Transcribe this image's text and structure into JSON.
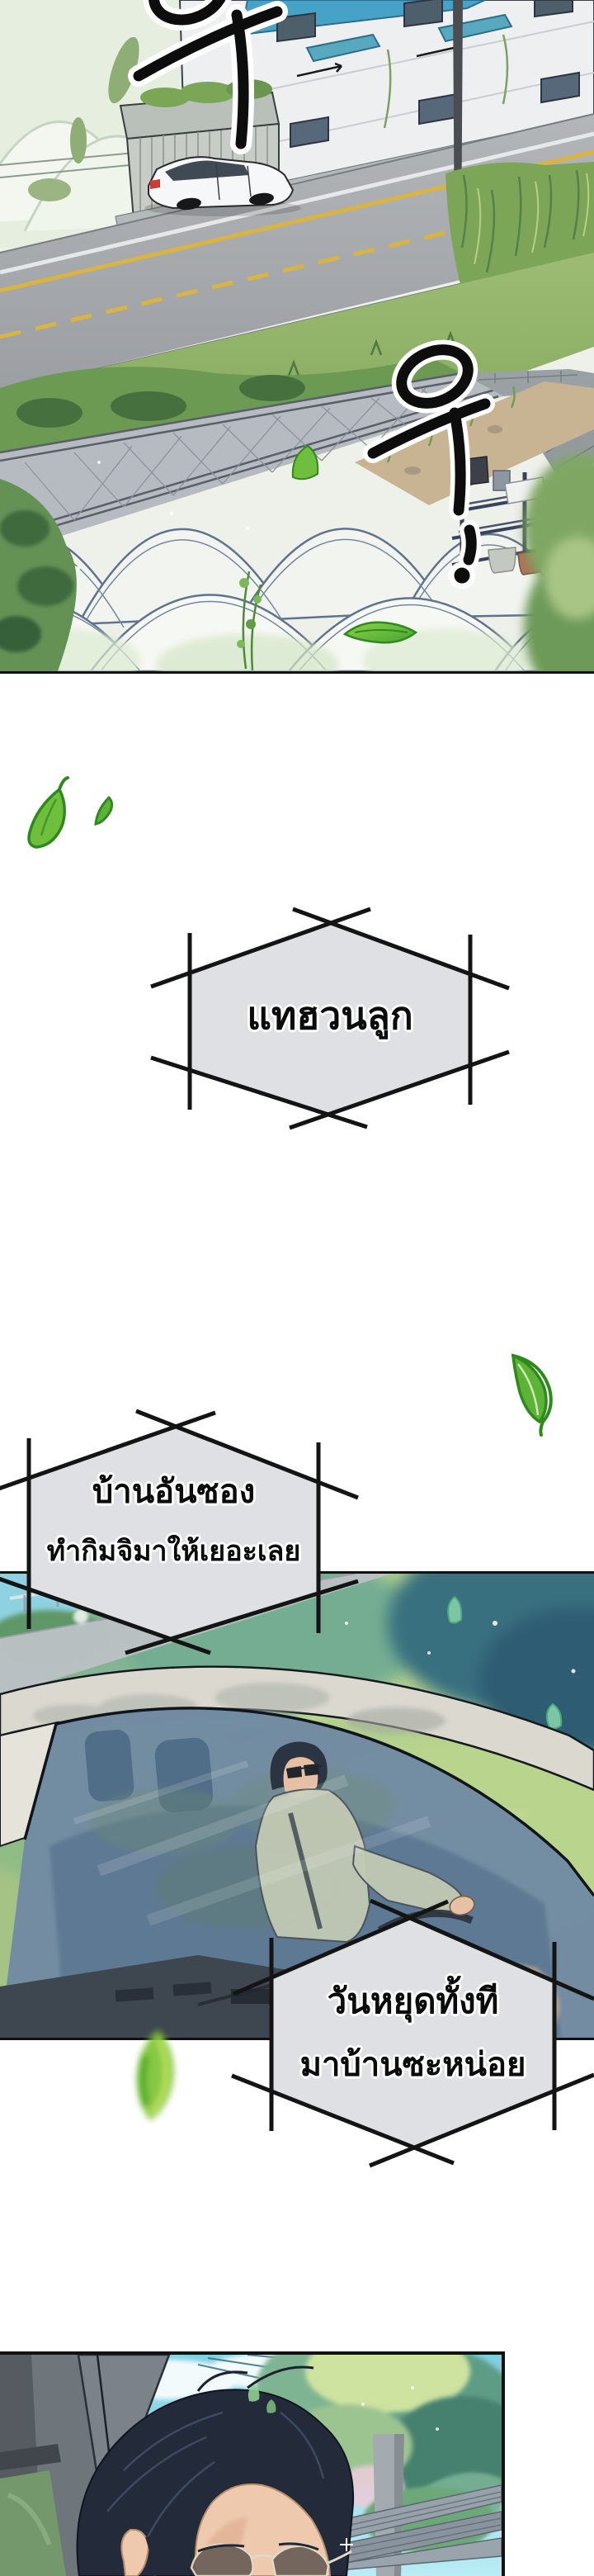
{
  "page": {
    "kind": "webtoon-episode-page",
    "background": "#ffffff"
  },
  "sound_effects": [
    {
      "text": "우"
    },
    {
      "text": "웅"
    }
  ],
  "speech_bubbles": [
    {
      "shape": "hexagon",
      "lines": [
        "แทฮวนลูก"
      ]
    },
    {
      "shape": "hexagon",
      "lines": [
        "บ้านอันซอง",
        "ทำกิมจิมาให้เยอะเลย"
      ]
    },
    {
      "shape": "hexagon",
      "lines": [
        "วันหยุดทั้งที",
        "มาบ้านซะหน่อย"
      ]
    }
  ],
  "colors": {
    "panel_border": "#111111",
    "bubble_fill": "#dfe0e3",
    "bubble_outline": "#141414",
    "leaf_green": "#63bb3c",
    "leaf_dark": "#2f8a1e",
    "sky_cyan": "#86d4e6",
    "roof_blue": "#47a2c8",
    "road_gray": "#a7abae",
    "grass_green": "#8cae67",
    "windshield_blue": "#7089a2"
  }
}
